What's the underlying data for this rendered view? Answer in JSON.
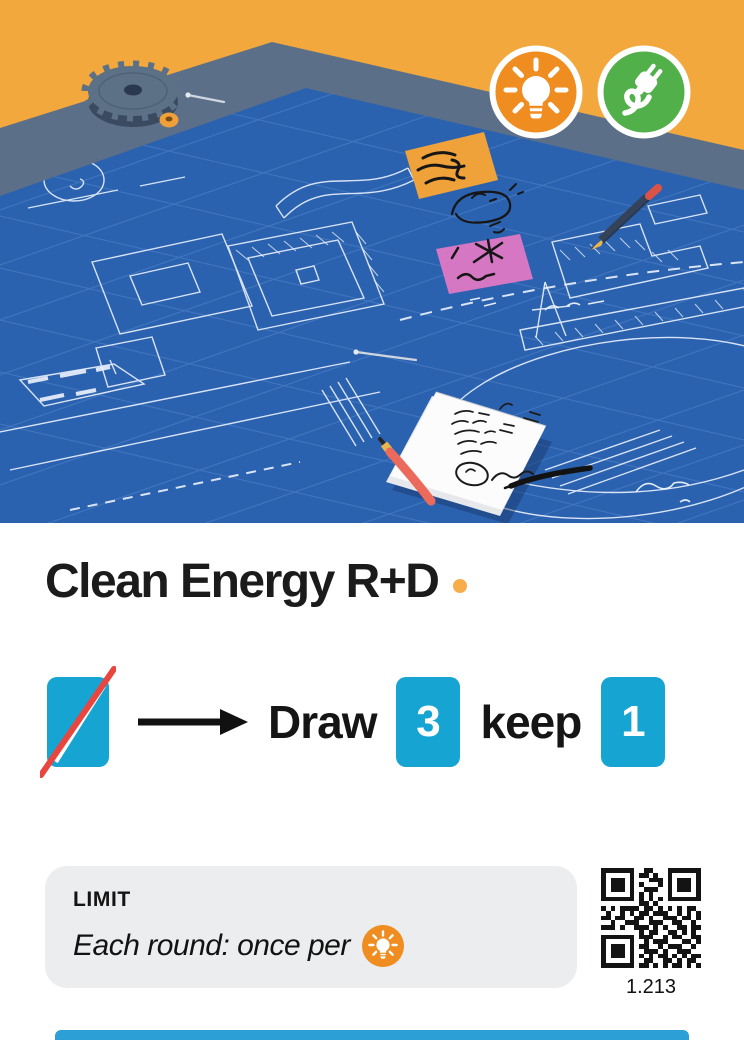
{
  "card": {
    "title": "Clean Energy R+D"
  },
  "badges": {
    "icons": [
      "lightbulb-icon",
      "plug-icon"
    ]
  },
  "action": {
    "discard_icon": "no-card-icon",
    "arrow_icon": "arrow-right-icon",
    "draw_label": "Draw",
    "draw_count": "3",
    "keep_label": "keep",
    "keep_count": "1"
  },
  "limit": {
    "heading": "LIMIT",
    "text": "Each round: once per",
    "icon": "lightbulb-icon"
  },
  "qr": {
    "label": "1.213",
    "matrix": [
      "111111100110001111111",
      "100000101101001000001",
      "101110100011101011101",
      "101110101000101011101",
      "101110100111001011101",
      "100000101010001000001",
      "111111101010101111111",
      "000000001101000000000",
      "101011110110101010110",
      "010010101101110010101",
      "110110011010011101101",
      "001001110011100110010",
      "111010011101010011011",
      "000000001011001101010",
      "111111101110010110011",
      "100000100101110001101",
      "101110101100101110010",
      "101110100111010011100",
      "101110101010110101011",
      "100000100110011010110",
      "111111101101010110101"
    ]
  },
  "palette": {
    "cyan": "#16A4D2",
    "limit_bg": "#ECEDEF",
    "dot": "#F8AC4A",
    "bar": "#2B9FD6",
    "ink": "#1B1B1B",
    "badge_orange": "#EF8D21",
    "badge_green": "#52B04B",
    "art_orange": "#F2A83C",
    "art_blueprint": "#2A62B0",
    "art_table": "#5C6F88",
    "slash_red": "#E8463E"
  }
}
